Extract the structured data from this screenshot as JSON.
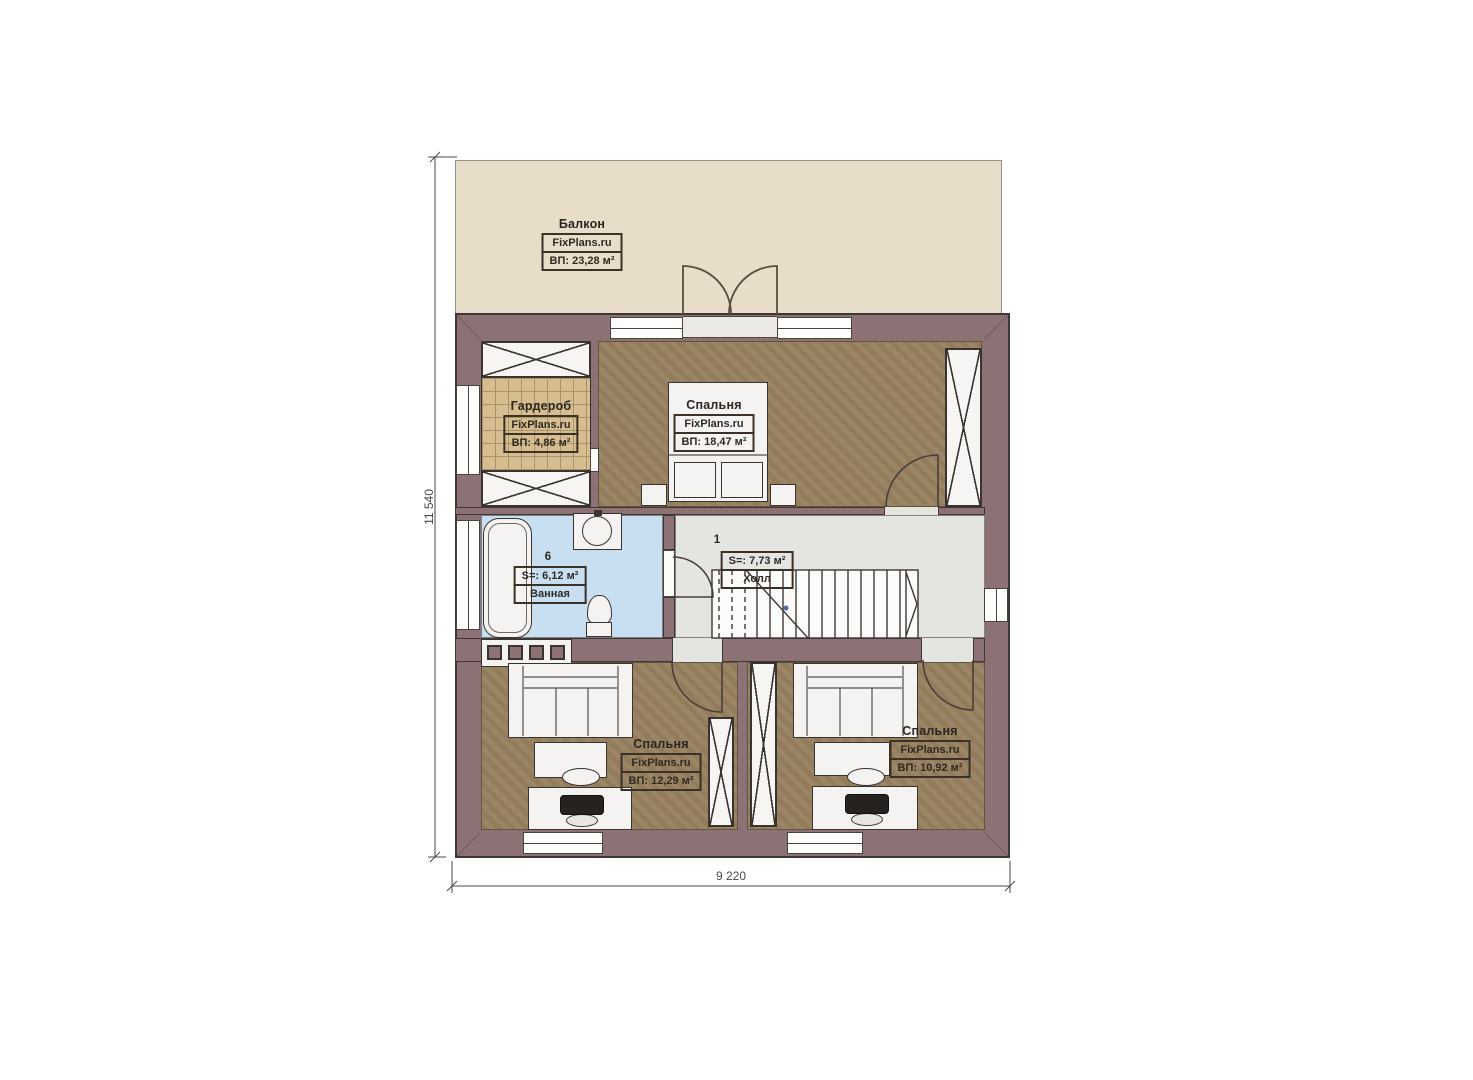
{
  "plan_title": "Floor plan — second floor",
  "rooms": {
    "balcony": {
      "name": "Балкон",
      "brand": "FixPlans.ru",
      "area": "ВП: 23,28 м²"
    },
    "wardrobe": {
      "name": "Гардероб",
      "brand": "FixPlans.ru",
      "area": "ВП: 4,86 м²"
    },
    "bedroom_top": {
      "name": "Спальня",
      "brand": "FixPlans.ru",
      "area": "ВП: 18,47 м²"
    },
    "bathroom": {
      "name": "Ванная",
      "number": "6",
      "area": "S=: 6,12 м²"
    },
    "hall": {
      "name": "Холл",
      "number": "1",
      "area": "S=: 7,73 м²"
    },
    "bedroom_left": {
      "name": "Спальня",
      "brand": "FixPlans.ru",
      "area": "ВП: 12,29 м²"
    },
    "bedroom_right": {
      "name": "Спальня",
      "brand": "FixPlans.ru",
      "area": "ВП: 10,92 м²"
    }
  },
  "dimensions": {
    "height": "11 540",
    "width": "9 220"
  },
  "colors": {
    "wall": "#8c7175",
    "outline": "#3f3735",
    "floor_brown": "#97815f",
    "bathroom_blue": "#c8dff2",
    "hall_gray": "#e4e4e1",
    "balcony_beige": "#e8ddc8",
    "wardrobe_tan": "#d7be91"
  }
}
